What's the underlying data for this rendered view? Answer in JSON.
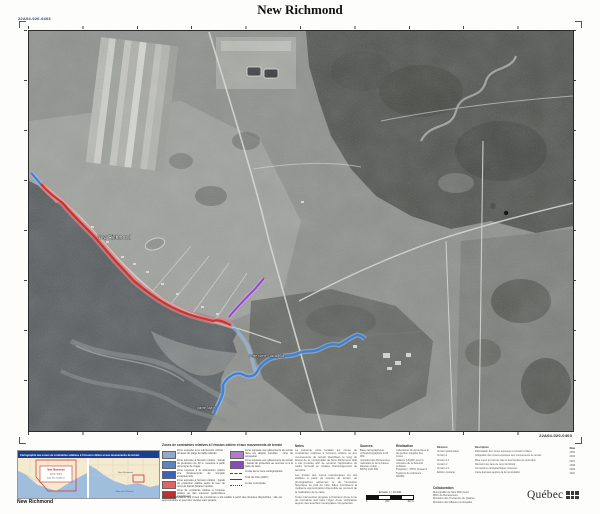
{
  "header": {
    "title": "New Richmond",
    "sheet_code": "22A04-020-0403"
  },
  "map": {
    "place_label": "New Richmond",
    "river_label": "Petite rivière Cascapédia",
    "point_label": "pointe Taylor",
    "colors": {
      "erosion_zone": "#cc2a2a",
      "submersion_line": "#3f7fd4",
      "landslide_line": "#8f46c8"
    }
  },
  "footer": {
    "bottom_code": "22A04-020-0403",
    "inset": {
      "banner": "Cartographie des zones de contraintes relatives à l'érosion côtière et aux mouvements de terrain",
      "callout_line1": "New Richmond",
      "callout_line2": "pointe Taylor",
      "callout_line3": "baie des Chaleurs",
      "region_label": "New Richmond",
      "water_label": "Baie des Chaleurs",
      "sheet_label": "New Richmond"
    },
    "legend": {
      "header": "Zones de contraintes relatives à l'érosion côtière et aux mouvements de terrain",
      "items_left": [
        {
          "color": "#8fa8cc",
          "text": "Zone exposée à la submersion côtière : terrasse de plage de faible altitude."
        },
        {
          "color": "#5f83c0",
          "text": "Zone exposée à l'érosion côtière : bande de protection de 30 m mesurée à partir de la ligne de rivage."
        },
        {
          "color": "#3a62b5",
          "text": "Zone exposée à la submersion côtière lors d'événements de tempête exceptionnels."
        },
        {
          "color": "#e06666",
          "text": "Zone exposée à l'érosion côtière : bande de protection établie selon le taux de recul du littoral (falaise meuble)."
        },
        {
          "color": "#c03030",
          "text": "Zone de contrainte relative à l'érosion côtière où des mesures particulières s'appliquent."
        }
      ],
      "items_right": [
        {
          "color": "#b07cc8",
          "text": "Zone exposée aux glissements de terrain dans les dépôts meubles : zone de précaution."
        },
        {
          "color": "#8a4ab8",
          "text": "Zone exposée aux glissements de terrain : bande de protection au sommet et à la base du talus."
        }
      ],
      "line_items": [
        {
          "label": "Limite de la zone cartographiée"
        },
        {
          "label": "Trait de côte (2007)"
        },
        {
          "label": "Limite municipale"
        }
      ],
      "note": "Note : la délimitation des zones de contraintes a été établie à partir des données disponibles ; elle est approximative et peut être révisée sans préavis."
    },
    "notes": {
      "heading": "Notes",
      "p1": "La présente carte localise les zones de contraintes relatives à l'érosion côtière et aux mouvements de terrain identifiées le long du littoral de la municipalité de New Richmond. Elle a été produite afin de soutenir l'application du cadre normatif en matière d'aménagement du territoire.",
      "p2": "Les limites des zones représentées ont été établies à partir de relevés de terrain, de photographies aériennes et de l'évolution historique du trait de côte. Elles constituent la meilleure approximation disponible au moment de la réalisation de la carte.",
      "p3": "Toute intervention projetée à l'intérieur d'une zone de contrainte doit faire l'objet d'une vérification auprès des autorités municipales compétentes."
    },
    "sources": {
      "col1_heading": "Sources",
      "col1_lines": [
        "Base cartographique :",
        "orthophotographies 1/15 000,",
        "ministère des Ressources",
        "naturelles et de la Faune.",
        "Réseau routier :",
        "BDTQ 1/20 000."
      ],
      "col2_heading": "Réalisation",
      "col2_lines": [
        "Laboratoire de dynamique et",
        "de gestion intégrée des zones",
        "côtières (UQAR) pour le",
        "ministère de la Sécurité publique.",
        "Projection : MTM, fuseau 5",
        "Système de référence : NAD83"
      ],
      "scale_label": "Échelle 1 / 10 000",
      "tick0": "0",
      "tick1": "200",
      "tick2": "400 m"
    },
    "revisions": {
      "h1": "Révision",
      "h2": "Description",
      "h3": "Date",
      "rows": [
        {
          "c1": "Version préliminaire",
          "c2": "Délimitation des zones exposées à l'érosion côtière",
          "c3": "2005"
        },
        {
          "c1": "Version 1",
          "c2": "Intégration des zones exposées aux mouvements de terrain",
          "c3": "2006"
        },
        {
          "c1": "Version 1.1",
          "c2": "Mise à jour du trait de côte et des bandes de protection",
          "c3": "2007"
        },
        {
          "c1": "Version 2",
          "c2": "Révision des taux de recul du littoral",
          "c3": "2008"
        },
        {
          "c1": "Version 2.1",
          "c2": "Corrections cartographiques mineures",
          "c3": "2009"
        },
        {
          "c1": "Édition courante",
          "c2": "Carte déposée auprès de la municipalité",
          "c3": "2010"
        }
      ]
    },
    "collaboration": {
      "heading": "Collaboration",
      "lines": [
        "Municipalité de New Richmond",
        "MRC de Bonaventure",
        "Ministère des Transports du Québec",
        "Ministère des Affaires municipales"
      ]
    },
    "logo_text": "Québec"
  }
}
